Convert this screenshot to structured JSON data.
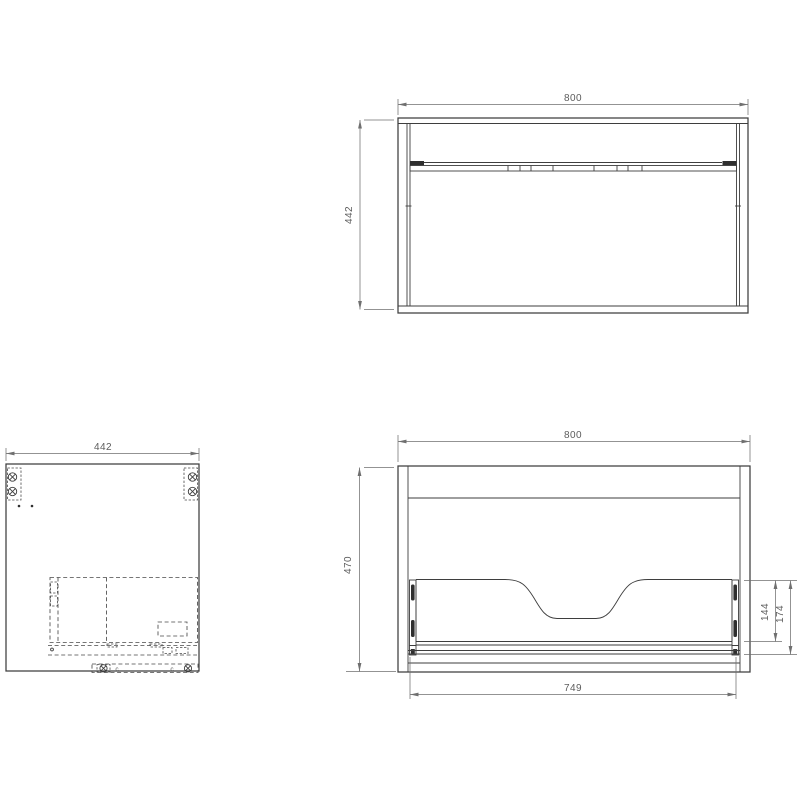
{
  "colors": {
    "background": "#ffffff",
    "object_line": "#3e3e3e",
    "hidden_line": "#4a4a4a",
    "dimension_line": "#6f6f6f",
    "dimension_text": "#5c5c5c"
  },
  "views": {
    "top_view": {
      "width_dim": "800",
      "depth_dim": "442"
    },
    "side_view": {
      "width_dim": "442",
      "hardware_label_left": "c",
      "hardware_label_right": "c"
    },
    "front_view": {
      "width_dim": "800",
      "height_dim": "470",
      "drawer_width_dim": "749",
      "drawer_back_height_dim": "144",
      "drawer_back_total_height_dim": "174"
    }
  }
}
